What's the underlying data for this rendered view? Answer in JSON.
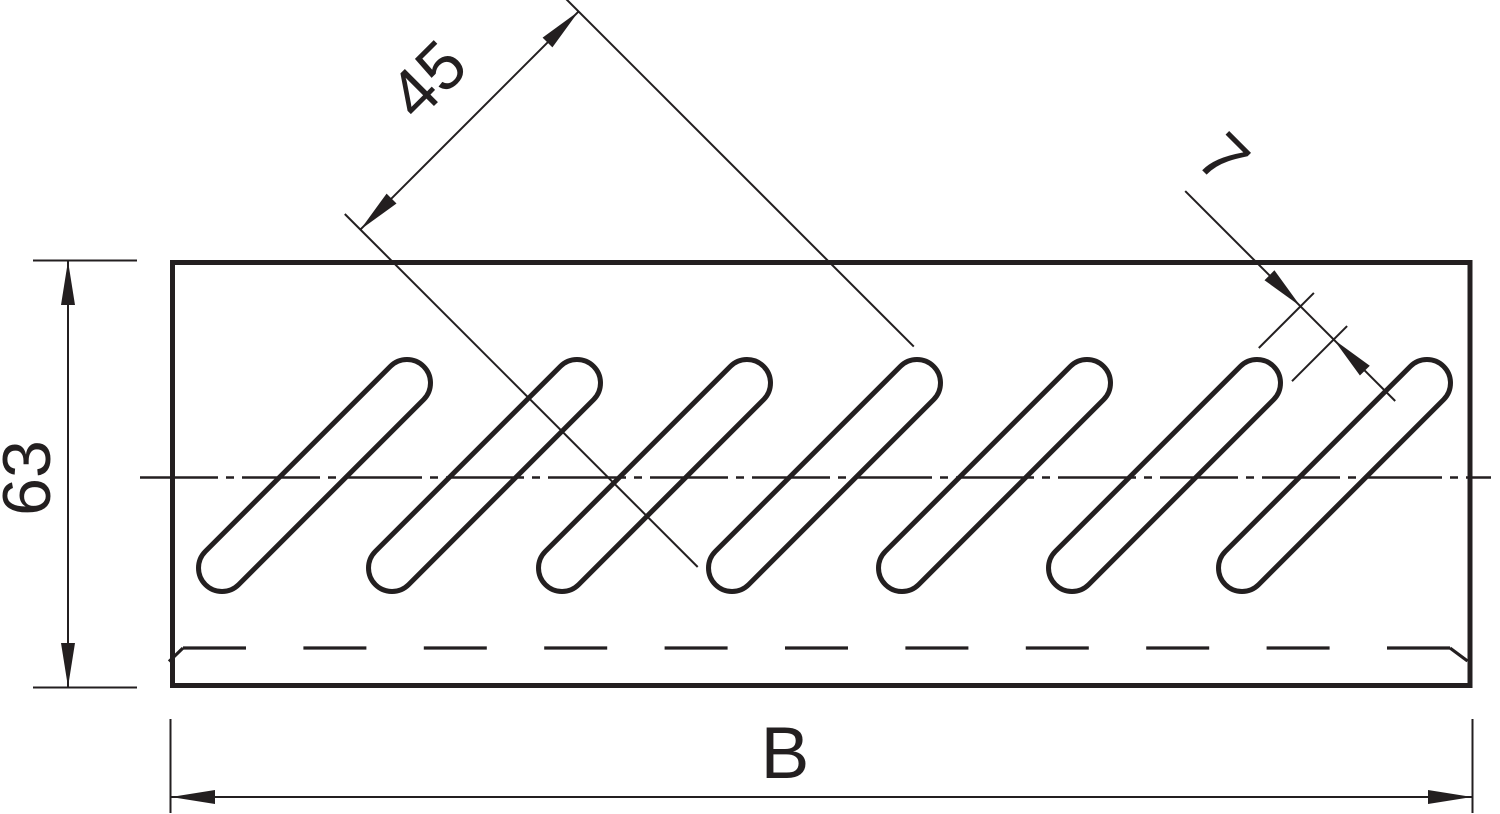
{
  "drawing": {
    "dimensions": {
      "slot_length": "45",
      "slot_width": "7",
      "plate_height": "63",
      "plate_width": "B"
    },
    "figure": {
      "slot_count": 7
    },
    "colors": {
      "line": "#231f20",
      "background": "#ffffff"
    }
  }
}
